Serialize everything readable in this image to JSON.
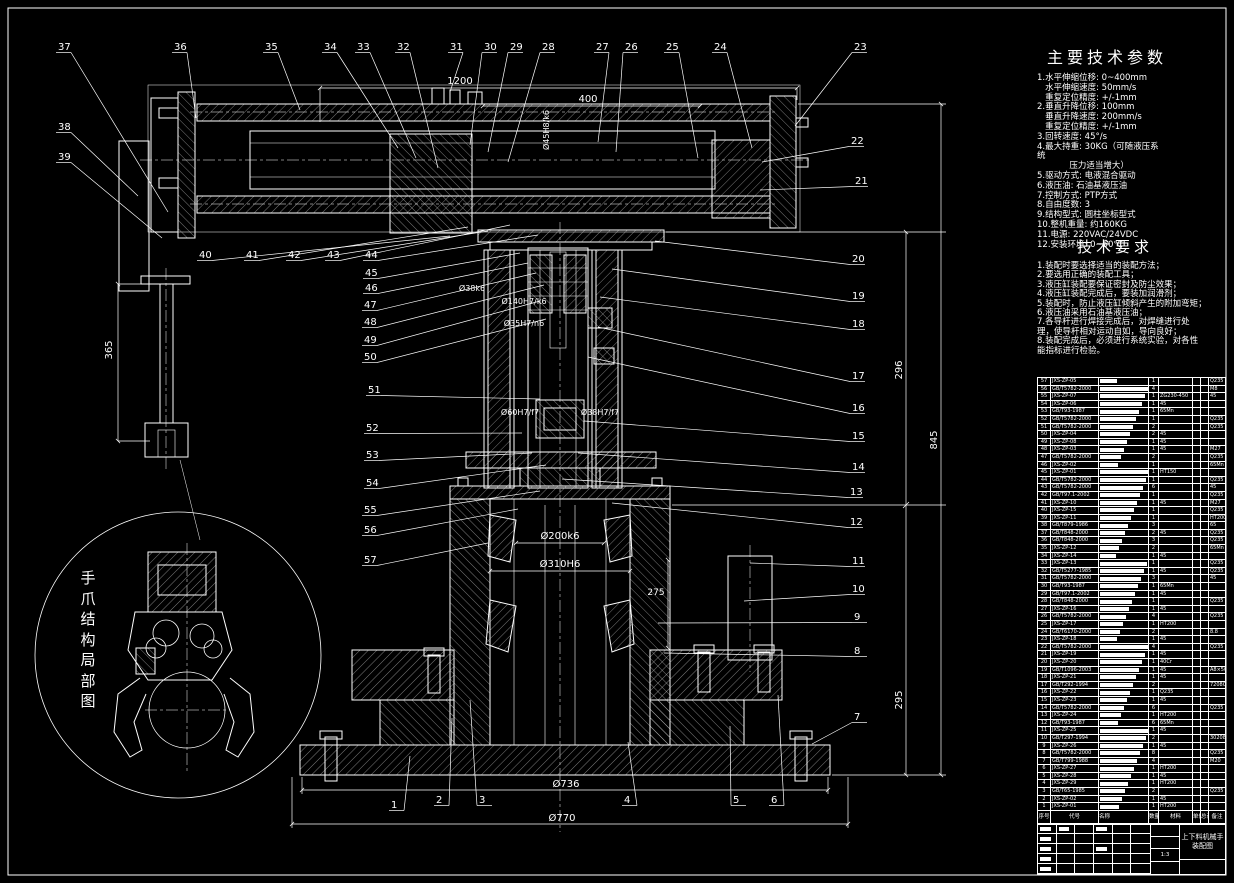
{
  "sheet": {
    "background": "#000000",
    "line_color": "#ffffff"
  },
  "right_panel": {
    "tech_params": {
      "title": "主要技术参数",
      "lines": [
        "1.水平伸缩位移: 0~400mm",
        "   水平伸缩速度: 50mm/s",
        "   重复定位精度: +/-1mm",
        "2.垂直升降位移: 100mm",
        "   垂直升降速度: 200mm/s",
        "   重复定位精度: +/-1mm",
        "3.回转速度: 45°/s",
        "4.最大持重: 30KG（可随液压系",
        "统",
        "            压力适当增大）",
        "5.驱动方式: 电液混合驱动",
        "6.液压油: 石油基液压油",
        "7.控制方式: PTP方式",
        "8.自由度数: 3",
        "9.结构型式: 圆柱坐标型式",
        "10.整机重量: 约160KG",
        "11.电源: 220VAC/24VDC",
        "12.安装环境: 0~50℃"
      ]
    },
    "tech_requirements": {
      "title": "技术要求",
      "lines": [
        "1.装配时要选择适当的装配方法；",
        "2.要选用正确的装配工具；",
        "3.液压缸装配要保证密封及防尘效果；",
        "4.液压缸装配完成后，要装加润滑剂；",
        "5.装配时，防止液压缸倾斜产生的附加弯矩；",
        "6.液压油采用石油基液压油；",
        "7.各导杆进行焊接完成后，对焊缝进行处",
        "理，使导杆相对运动自如，导向良好；",
        "8.装配完成后，必须进行系统实验，对各性",
        "能指标进行检验。"
      ]
    }
  },
  "detail_view": {
    "label": "手爪结构局部图"
  },
  "parts_table": {
    "headers": [
      "序号",
      "代号",
      "名称",
      "数量",
      "材料",
      "单件",
      "总计",
      "备注"
    ],
    "rows": [
      [
        57,
        "JXS-ZP-05",
        "1",
        "",
        "Q235"
      ],
      [
        56,
        "GB/T5782-2000",
        "4",
        "",
        "M8"
      ],
      [
        55,
        "JXS-ZP-07",
        "1",
        "ZG230-450",
        "45"
      ],
      [
        54,
        "JXS-ZP-06",
        "1",
        "45",
        ""
      ],
      [
        53,
        "GB/T93-1987",
        "1",
        "65Mn",
        ""
      ],
      [
        52,
        "GB/T5782-2000",
        "1",
        "",
        "Q235"
      ],
      [
        51,
        "GB/T5782-2000",
        "2",
        "",
        "Q235"
      ],
      [
        50,
        "JXS-ZP-04",
        "2",
        "45",
        ""
      ],
      [
        49,
        "JXS-ZP-08",
        "1",
        "45",
        ""
      ],
      [
        48,
        "JXS-ZP-03",
        "1",
        "45",
        "M27"
      ],
      [
        47,
        "GB/T5782-2000",
        "2",
        "",
        "Q235"
      ],
      [
        46,
        "JXS-ZP-02",
        "1",
        "",
        "65Mn"
      ],
      [
        45,
        "JXS-ZP-01",
        "1",
        "HT150",
        ""
      ],
      [
        44,
        "GB/T5782-2000",
        "1",
        "",
        "Q235"
      ],
      [
        43,
        "GB/T5782-2000",
        "6",
        "",
        "45"
      ],
      [
        42,
        "GB/T97.1-2002",
        "1",
        "",
        "Q235"
      ],
      [
        41,
        "JXS-ZP-10",
        "1",
        "45",
        "M27"
      ],
      [
        40,
        "JXS-ZP-15",
        "1",
        "",
        "Q235"
      ],
      [
        39,
        "JXS-ZP-11",
        "1",
        "",
        "HT200"
      ],
      [
        38,
        "GB/T879-1986",
        "3",
        "",
        "65"
      ],
      [
        37,
        "GB/T848-2000",
        "2",
        "45",
        "Q235"
      ],
      [
        36,
        "GB/T848-2000",
        "3",
        "",
        "Q235"
      ],
      [
        35,
        "JXS-ZP-12",
        "2",
        "",
        "65Mn"
      ],
      [
        34,
        "JXS-ZP-14",
        "1",
        "45",
        ""
      ],
      [
        33,
        "JXS-ZP-13",
        "1",
        "",
        "Q235"
      ],
      [
        32,
        "GB/T5277-1985",
        "1",
        "45",
        "Q235"
      ],
      [
        31,
        "GB/T5782-2000",
        "3",
        "",
        "45"
      ],
      [
        30,
        "GB/T93-1987",
        "1",
        "65Mn",
        ""
      ],
      [
        29,
        "GB/T97.1-2002",
        "1",
        "45",
        ""
      ],
      [
        28,
        "GB/T848-2000",
        "1",
        "",
        "Q235"
      ],
      [
        27,
        "JXS-ZP-16",
        "1",
        "45",
        ""
      ],
      [
        26,
        "GB/T5782-2000",
        "4",
        "",
        "Q235"
      ],
      [
        25,
        "JXS-ZP-17",
        "1",
        "HT200",
        ""
      ],
      [
        24,
        "GB/T6170-2000",
        "2",
        "",
        "8.8"
      ],
      [
        23,
        "JXS-ZP-18",
        "1",
        "45",
        ""
      ],
      [
        22,
        "GB/T5782-2000",
        "4",
        "",
        "Q235"
      ],
      [
        21,
        "JXS-ZP-19",
        "1",
        "45",
        ""
      ],
      [
        20,
        "JXS-ZP-20",
        "1",
        "40Cr",
        ""
      ],
      [
        19,
        "GB/T1096-2003",
        "1",
        "45",
        "A8×50"
      ],
      [
        18,
        "JXS-ZP-21",
        "1",
        "45",
        ""
      ],
      [
        17,
        "GB/T292-1994",
        "2",
        "",
        "7208C"
      ],
      [
        16,
        "JXS-ZP-22",
        "1",
        "Q235",
        ""
      ],
      [
        15,
        "JXS-ZP-23",
        "1",
        "45",
        ""
      ],
      [
        14,
        "GB/T5782-2000",
        "6",
        "",
        "Q235"
      ],
      [
        13,
        "JXS-ZP-24",
        "1",
        "HT200",
        ""
      ],
      [
        12,
        "GB/T93-1987",
        "6",
        "65Mn",
        ""
      ],
      [
        11,
        "JXS-ZP-25",
        "1",
        "45",
        ""
      ],
      [
        10,
        "GB/T297-1994",
        "2",
        "",
        "30208"
      ],
      [
        9,
        "JXS-ZP-26",
        "1",
        "45",
        ""
      ],
      [
        8,
        "GB/T5782-2000",
        "8",
        "",
        "Q235"
      ],
      [
        7,
        "GB/T799-1988",
        "4",
        "",
        "M20"
      ],
      [
        6,
        "JXS-ZP-27",
        "1",
        "HT200",
        ""
      ],
      [
        5,
        "JXS-ZP-28",
        "1",
        "45",
        ""
      ],
      [
        4,
        "JXS-ZP-29",
        "1",
        "HT200",
        ""
      ],
      [
        3,
        "GB/T65-1985",
        "2",
        "",
        "Q235"
      ],
      [
        2,
        "JXS-ZP-02",
        "1",
        "45",
        ""
      ],
      [
        1,
        "JXS-ZP-01",
        "1",
        "HT200",
        ""
      ]
    ]
  },
  "title_block": {
    "product_name": "上下料机械手",
    "sheet_name": "装配图",
    "scale": "1:3"
  },
  "drawing": {
    "callouts": [
      {
        "n": "37",
        "x": 58,
        "y": 50,
        "tx": 168,
        "ty": 212
      },
      {
        "n": "36",
        "x": 174,
        "y": 50,
        "tx": 196,
        "ty": 118
      },
      {
        "n": "35",
        "x": 265,
        "y": 50,
        "tx": 300,
        "ty": 110
      },
      {
        "n": "34",
        "x": 324,
        "y": 50,
        "tx": 398,
        "ty": 148
      },
      {
        "n": "33",
        "x": 357,
        "y": 50,
        "tx": 416,
        "ty": 158
      },
      {
        "n": "32",
        "x": 397,
        "y": 50,
        "tx": 438,
        "ty": 168
      },
      {
        "n": "31",
        "x": 450,
        "y": 50,
        "tx": 450,
        "ty": 92
      },
      {
        "n": "30",
        "x": 484,
        "y": 50,
        "tx": 470,
        "ty": 145
      },
      {
        "n": "29",
        "x": 510,
        "y": 50,
        "tx": 488,
        "ty": 152
      },
      {
        "n": "28",
        "x": 542,
        "y": 50,
        "tx": 508,
        "ty": 162
      },
      {
        "n": "27",
        "x": 596,
        "y": 50,
        "tx": 598,
        "ty": 142
      },
      {
        "n": "26",
        "x": 625,
        "y": 50,
        "tx": 616,
        "ty": 152
      },
      {
        "n": "25",
        "x": 666,
        "y": 50,
        "tx": 698,
        "ty": 158
      },
      {
        "n": "24",
        "x": 714,
        "y": 50,
        "tx": 752,
        "ty": 148
      },
      {
        "n": "23",
        "x": 854,
        "y": 50,
        "tx": 795,
        "ty": 126
      },
      {
        "n": "38",
        "x": 58,
        "y": 130,
        "tx": 138,
        "ty": 196
      },
      {
        "n": "39",
        "x": 58,
        "y": 160,
        "tx": 162,
        "ty": 238
      },
      {
        "n": "40",
        "x": 199,
        "y": 258,
        "tx": 450,
        "ty": 236
      },
      {
        "n": "41",
        "x": 246,
        "y": 258,
        "tx": 468,
        "ty": 227
      },
      {
        "n": "42",
        "x": 288,
        "y": 258,
        "tx": 488,
        "ty": 231
      },
      {
        "n": "43",
        "x": 327,
        "y": 258,
        "tx": 510,
        "ty": 225
      },
      {
        "n": "44",
        "x": 365,
        "y": 258,
        "tx": 538,
        "ty": 235
      },
      {
        "n": "45",
        "x": 365,
        "y": 276,
        "tx": 520,
        "ty": 253
      },
      {
        "n": "46",
        "x": 365,
        "y": 291,
        "tx": 528,
        "ty": 263
      },
      {
        "n": "47",
        "x": 364,
        "y": 308,
        "tx": 536,
        "ty": 273
      },
      {
        "n": "48",
        "x": 364,
        "y": 325,
        "tx": 544,
        "ty": 285
      },
      {
        "n": "49",
        "x": 364,
        "y": 343,
        "tx": 540,
        "ty": 301
      },
      {
        "n": "50",
        "x": 364,
        "y": 360,
        "tx": 546,
        "ty": 319
      },
      {
        "n": "51",
        "x": 368,
        "y": 393,
        "tx": 540,
        "ty": 399
      },
      {
        "n": "52",
        "x": 366,
        "y": 431,
        "tx": 522,
        "ty": 433
      },
      {
        "n": "53",
        "x": 366,
        "y": 458,
        "tx": 532,
        "ty": 453
      },
      {
        "n": "54",
        "x": 366,
        "y": 486,
        "tx": 546,
        "ty": 465
      },
      {
        "n": "55",
        "x": 364,
        "y": 513,
        "tx": 540,
        "ty": 491
      },
      {
        "n": "56",
        "x": 364,
        "y": 533,
        "tx": 518,
        "ty": 509
      },
      {
        "n": "57",
        "x": 364,
        "y": 563,
        "tx": 488,
        "ty": 543
      },
      {
        "n": "22",
        "x": 851,
        "y": 144,
        "tx": 762,
        "ty": 162
      },
      {
        "n": "21",
        "x": 855,
        "y": 184,
        "tx": 760,
        "ty": 190
      },
      {
        "n": "20",
        "x": 852,
        "y": 262,
        "tx": 655,
        "ty": 241
      },
      {
        "n": "19",
        "x": 852,
        "y": 299,
        "tx": 612,
        "ty": 269
      },
      {
        "n": "18",
        "x": 852,
        "y": 327,
        "tx": 600,
        "ty": 297
      },
      {
        "n": "17",
        "x": 852,
        "y": 379,
        "tx": 598,
        "ty": 327
      },
      {
        "n": "16",
        "x": 852,
        "y": 411,
        "tx": 588,
        "ty": 357
      },
      {
        "n": "15",
        "x": 852,
        "y": 439,
        "tx": 584,
        "ty": 421
      },
      {
        "n": "14",
        "x": 852,
        "y": 470,
        "tx": 578,
        "ty": 453
      },
      {
        "n": "13",
        "x": 850,
        "y": 495,
        "tx": 562,
        "ty": 479
      },
      {
        "n": "12",
        "x": 850,
        "y": 525,
        "tx": 612,
        "ty": 503
      },
      {
        "n": "11",
        "x": 852,
        "y": 564,
        "tx": 750,
        "ty": 563
      },
      {
        "n": "10",
        "x": 852,
        "y": 592,
        "tx": 744,
        "ty": 601
      },
      {
        "n": "9",
        "x": 854,
        "y": 620,
        "tx": 658,
        "ty": 623
      },
      {
        "n": "8",
        "x": 854,
        "y": 654,
        "tx": 664,
        "ty": 653
      },
      {
        "n": "7",
        "x": 854,
        "y": 720,
        "tx": 812,
        "ty": 744
      },
      {
        "n": "1",
        "x": 391,
        "y": 808,
        "tx": 410,
        "ty": 756
      },
      {
        "n": "2",
        "x": 436,
        "y": 803,
        "tx": 452,
        "ty": 718
      },
      {
        "n": "3",
        "x": 479,
        "y": 803,
        "tx": 470,
        "ty": 700
      },
      {
        "n": "4",
        "x": 624,
        "y": 803,
        "tx": 628,
        "ty": 742
      },
      {
        "n": "5",
        "x": 733,
        "y": 803,
        "tx": 730,
        "ty": 726
      },
      {
        "n": "6",
        "x": 771,
        "y": 803,
        "tx": 778,
        "ty": 695
      }
    ],
    "dimensions": [
      {
        "t": "1200",
        "x": 460,
        "y": 84
      },
      {
        "t": "400",
        "x": 588,
        "y": 102
      },
      {
        "t": "Ø45H8/k6",
        "x": 549,
        "y": 130,
        "v": 1,
        "s": 8
      },
      {
        "t": "Ø38k6",
        "x": 472,
        "y": 291,
        "s": 8
      },
      {
        "t": "Ø140H7/k6",
        "x": 524,
        "y": 304,
        "s": 8
      },
      {
        "t": "Ø35H7/n6",
        "x": 524,
        "y": 326,
        "s": 8
      },
      {
        "t": "Ø60H7/f7",
        "x": 520,
        "y": 415,
        "s": 8
      },
      {
        "t": "Ø38H7/f7",
        "x": 600,
        "y": 415,
        "s": 8
      },
      {
        "t": "Ø200k6",
        "x": 560,
        "y": 539
      },
      {
        "t": "Ø310H6",
        "x": 560,
        "y": 567
      },
      {
        "t": "275",
        "x": 656,
        "y": 595,
        "s": 9
      },
      {
        "t": "Ø736",
        "x": 566,
        "y": 787
      },
      {
        "t": "Ø770",
        "x": 562,
        "y": 821
      },
      {
        "t": "365",
        "x": 112,
        "y": 350,
        "v": 1
      },
      {
        "t": "296",
        "x": 902,
        "y": 370,
        "v": 1
      },
      {
        "t": "845",
        "x": 937,
        "y": 440,
        "v": 1
      },
      {
        "t": "295",
        "x": 902,
        "y": 700,
        "v": 1
      }
    ]
  }
}
